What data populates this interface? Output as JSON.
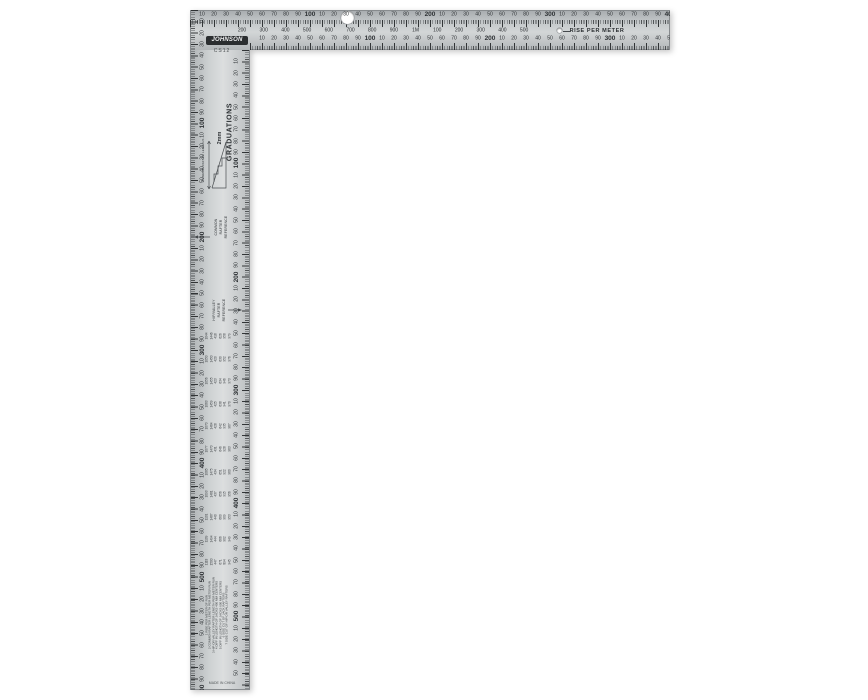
{
  "object": {
    "description": "metric steel framing square product photo",
    "colors": {
      "background": "#ffffff",
      "metal_light": "#dcdedf",
      "metal_mid": "#c3c7c9",
      "metal_dark": "#a7abae",
      "tick": "#2d3032",
      "text": "#2e3235"
    }
  },
  "logo": {
    "brand": "JOHNSON",
    "model": "CS12"
  },
  "blade": {
    "rise_text": "RISE PER METER",
    "outer_scale_labels": [
      "10",
      "20",
      "30",
      "40",
      "50",
      "60",
      "70",
      "80",
      "90",
      "100",
      "10",
      "20",
      "30",
      "40",
      "50",
      "60",
      "70",
      "80",
      "90",
      "200",
      "10",
      "20",
      "30",
      "40",
      "50",
      "60",
      "70",
      "80",
      "90",
      "300",
      "10",
      "20",
      "30",
      "40",
      "50",
      "60",
      "70",
      "80",
      "90",
      "400"
    ],
    "rise_row_labels": [
      "200",
      "300",
      "400",
      "500",
      "600",
      "700",
      "800",
      "900",
      "1M",
      "100",
      "200",
      "300",
      "400",
      "500"
    ],
    "inner_scale_labels": [
      "10",
      "20",
      "30",
      "40",
      "50",
      "60",
      "70",
      "80",
      "90",
      "100",
      "10",
      "20",
      "30",
      "40",
      "50",
      "60",
      "70",
      "80",
      "90",
      "200",
      "10",
      "20",
      "30",
      "40",
      "50",
      "60",
      "70",
      "80",
      "90",
      "300",
      "10",
      "20",
      "30",
      "40",
      "50"
    ]
  },
  "tongue": {
    "graduations_line1": "2mm",
    "graduations_line2": "GRADUATIONS",
    "common_ref": [
      "COMMON",
      "RAFTER",
      "REFERENCE"
    ],
    "hip_ref": [
      "HIP/VALLEY",
      "RAFTER",
      "REFERENCE"
    ],
    "diagram_label": "COMMON RAFTER LENGTHS",
    "outer_scale_labels": [
      "10",
      "20",
      "30",
      "40",
      "50",
      "60",
      "70",
      "80",
      "90",
      "100",
      "10",
      "20",
      "30",
      "40",
      "50",
      "60",
      "70",
      "80",
      "90",
      "200",
      "10",
      "20",
      "30",
      "40",
      "50",
      "60",
      "70",
      "80",
      "90",
      "300",
      "10",
      "20",
      "30",
      "40",
      "50",
      "60",
      "70",
      "80",
      "90",
      "400",
      "10",
      "20",
      "30",
      "40",
      "50",
      "60",
      "70",
      "80",
      "90",
      "500",
      "10",
      "20",
      "30",
      "40",
      "50",
      "60",
      "70",
      "80",
      "90",
      "600"
    ],
    "inner_scale_labels": [
      "10",
      "20",
      "30",
      "40",
      "50",
      "60",
      "70",
      "80",
      "90",
      "100",
      "10",
      "20",
      "30",
      "40",
      "50",
      "60",
      "70",
      "80",
      "90",
      "200",
      "10",
      "20",
      "30",
      "40",
      "50",
      "60",
      "70",
      "80",
      "90",
      "300",
      "10",
      "20",
      "30",
      "40",
      "50",
      "60",
      "70",
      "80",
      "90",
      "400",
      "10",
      "20",
      "30",
      "40",
      "50",
      "60",
      "70",
      "80",
      "90",
      "500",
      "10",
      "20",
      "30",
      "40",
      "50"
    ],
    "rafter_table": {
      "groups": [
        [
          "1044",
          "1446",
          "418",
          "626",
          "958",
          "979"
        ],
        [
          "1050",
          "1450",
          "420",
          "630",
          "952",
          "976"
        ],
        [
          "1056",
          "1455",
          "423",
          "634",
          "946",
          "973"
        ],
        [
          "1063",
          "1459",
          "425",
          "638",
          "941",
          "970"
        ],
        [
          "1070",
          "1464",
          "428",
          "642",
          "935",
          "967"
        ],
        [
          "1077",
          "1470",
          "431",
          "646",
          "928",
          "963"
        ],
        [
          "1085",
          "1475",
          "434",
          "651",
          "922",
          "960"
        ],
        [
          "1093",
          "1481",
          "437",
          "656",
          "915",
          "956"
        ],
        [
          "1101",
          "1487",
          "440",
          "660",
          "909",
          "953"
        ],
        [
          "1109",
          "1494",
          "444",
          "666",
          "902",
          "949"
        ],
        [
          "1118",
          "1500",
          "447",
          "671",
          "894",
          "945"
        ]
      ]
    },
    "legend_lines": [
      "1 RISE PER METER OF RUN",
      "2 COMMON RAFTER LENGTH PER METER RUN",
      "3 HIP OR VALLEY RAFTER LENGTH PER METER RUN",
      "4 DIFF IN LENGTH OF JACKS 400 MM CENTERS",
      "5 DIFF IN LENGTH OF JACKS 600 MM CENTERS",
      "6 SIDE CUT OF JACK RAFTERS",
      "7 SIDE CUT OF HIP OR VALLEY RAFTERS"
    ],
    "fine_print": "MADE IN CHINA"
  }
}
